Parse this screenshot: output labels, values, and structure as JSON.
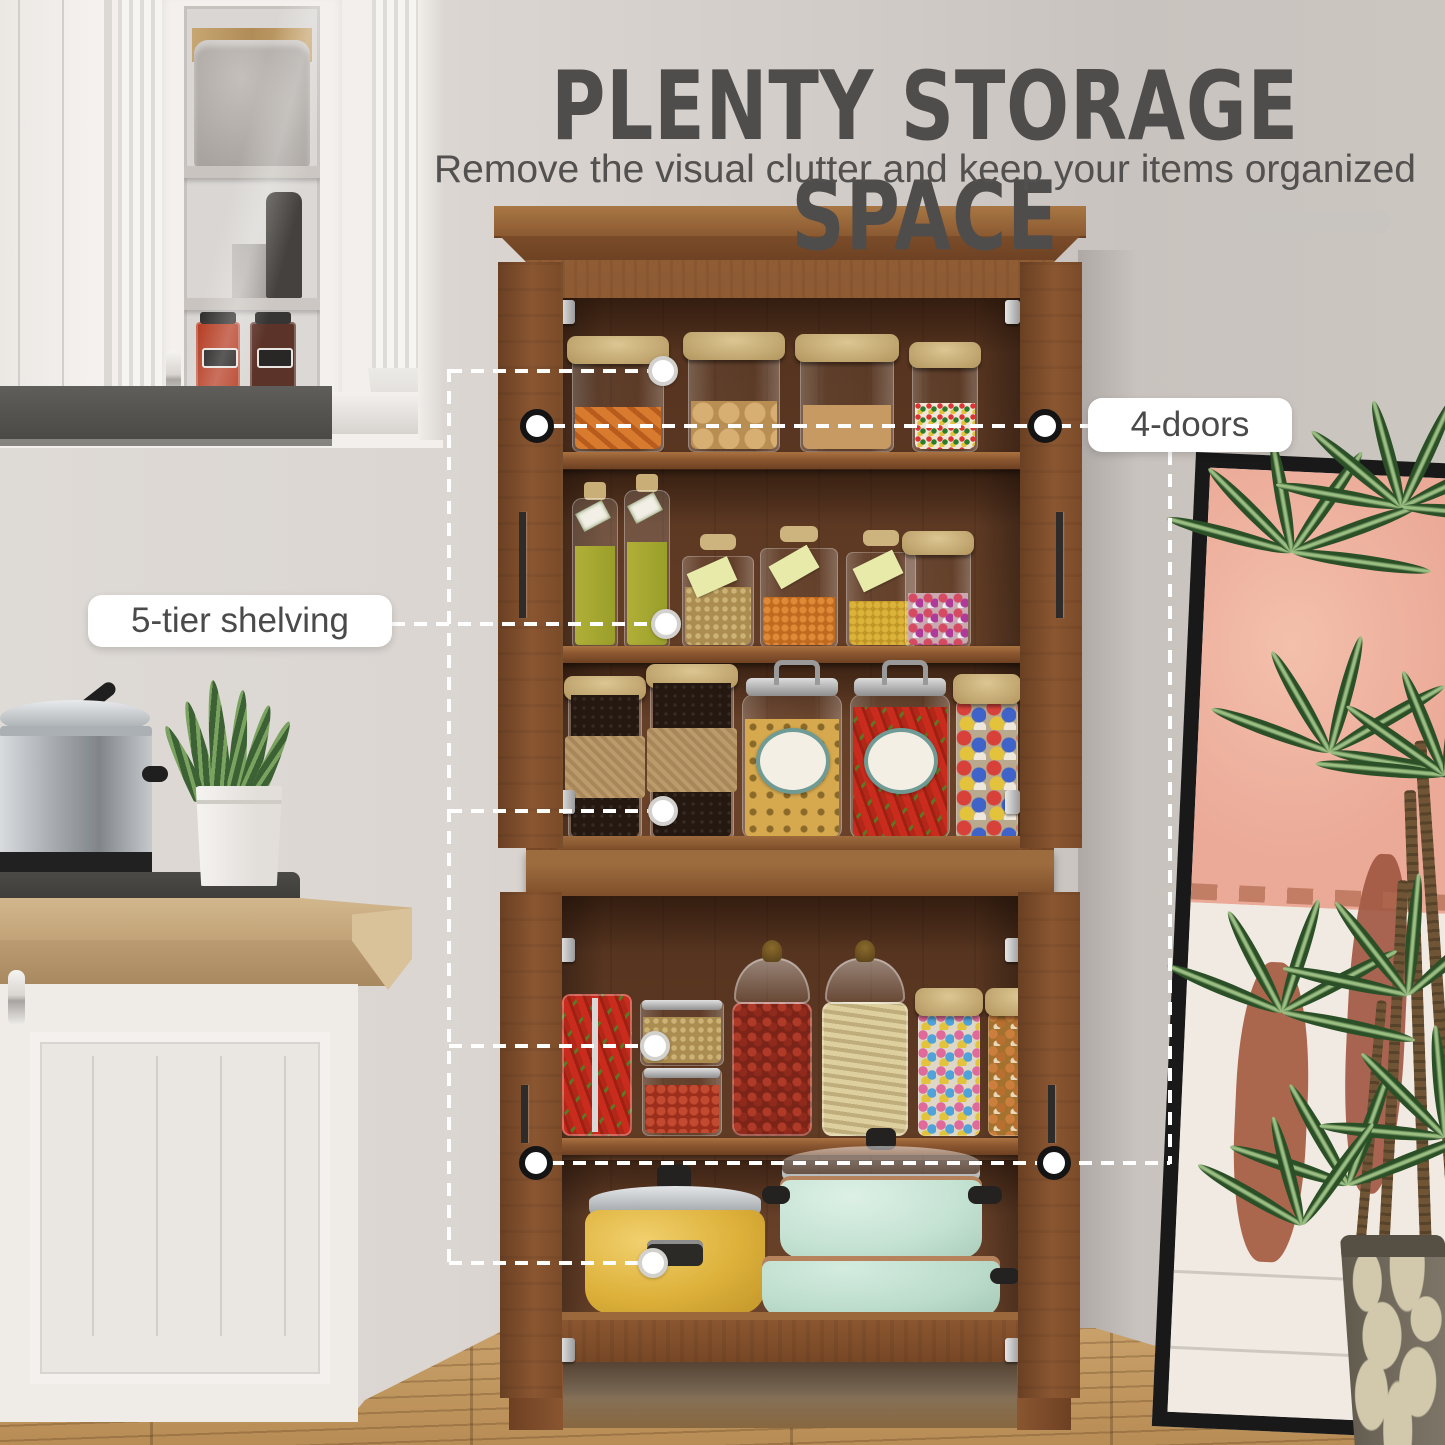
{
  "header": {
    "title": "PLENTY STORAGE SPACE",
    "subtitle": "Remove the visual clutter and keep your items organized"
  },
  "callouts": {
    "doors": {
      "label": "4-doors",
      "count": 4
    },
    "shelving": {
      "label": "5-tier shelving",
      "tiers": 5
    }
  },
  "colors": {
    "wall": "#d7d2cd",
    "annotation_line": "#ffffff",
    "label_text": "#4a4a4a",
    "title_text": "#4e4d4c",
    "cabinet_wood": "#8a5631",
    "cabinet_interior": "#5d3a23",
    "floor": "#bf955e",
    "yellow_pot": "#e0b33c",
    "mint_pot": "#c8e4d6",
    "art_pink": "#eeb09b",
    "art_terracotta": "#a55a41"
  }
}
